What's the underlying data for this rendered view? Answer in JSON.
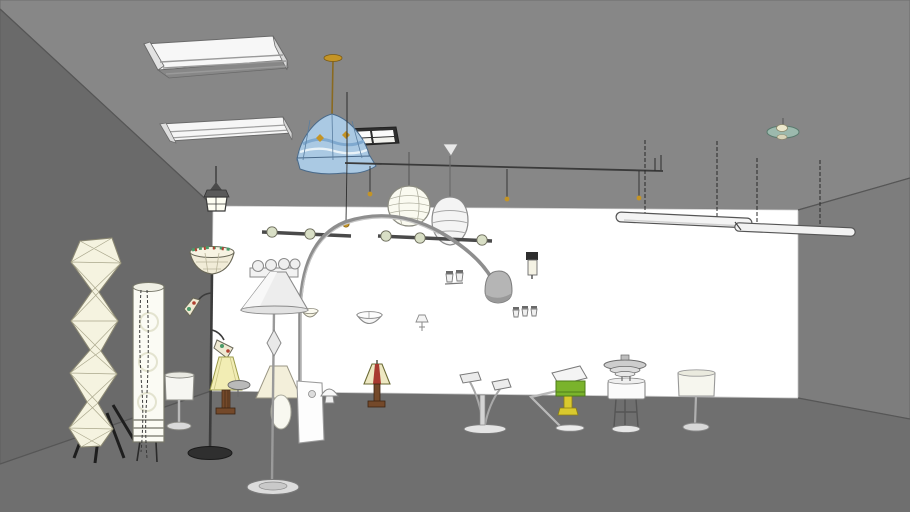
{
  "viewport": {
    "type": "3d-model-viewport",
    "description": "Showroom scene of lamp and light-fixture 3D models"
  },
  "colors": {
    "ceiling": "#878787",
    "wall_left": "#6a6a6a",
    "wall_right": "#7d7d7d",
    "wall_back": "#ffffff",
    "floor": "#6f6f6f",
    "fixture_white": "#f4f4f4",
    "paper_cream": "#f5f3e0",
    "shade_blue": "#aac9e3",
    "shade_blue_band": "#7fa9cf",
    "gold": "#c49425",
    "green_lamp": "#7ab32c",
    "yellow_metal": "#d9c92e",
    "wood_brown": "#74492a",
    "stripe_red": "#a83a30",
    "saucer_teal": "#9cb9ad",
    "metal_gray": "#9a9a9a",
    "metal_dark": "#3f3f3f",
    "dome_gray": "#b5b5b5",
    "mission_shade": "#eee8c2",
    "yellow_shade": "#f2edb4",
    "base_black": "#2f2f2f"
  },
  "scene": {
    "room_surfaces": [
      "ceiling",
      "left-wall",
      "back-wall",
      "right-wall",
      "floor"
    ],
    "ceiling_fixtures": [
      {
        "name": "fluorescent-troffer-1"
      },
      {
        "name": "fluorescent-strip-2"
      },
      {
        "name": "grid-panel-light"
      },
      {
        "name": "tiffany-blue-pendant"
      },
      {
        "name": "lantern-pendant"
      },
      {
        "name": "paper-sphere-pendant"
      },
      {
        "name": "cable-rail-system"
      },
      {
        "name": "ovoid-pendant"
      },
      {
        "name": "suspended-tube-light-1"
      },
      {
        "name": "suspended-tube-light-2"
      },
      {
        "name": "saucer-pendant"
      }
    ],
    "wall_fixtures": [
      {
        "name": "track-bar-left"
      },
      {
        "name": "track-bar-right"
      },
      {
        "name": "vanity-bulb-bar"
      },
      {
        "name": "half-bowl-sconce-small"
      },
      {
        "name": "half-bowl-sconce"
      },
      {
        "name": "torch-sconce"
      },
      {
        "name": "double-cup-sconce"
      },
      {
        "name": "box-sconce"
      },
      {
        "name": "triple-cup-sconce"
      }
    ],
    "floor_lamps": [
      {
        "name": "noguchi-paper-lamp"
      },
      {
        "name": "cylinder-paper-lamp"
      },
      {
        "name": "tiffany-torchiere"
      },
      {
        "name": "cone-shade-floor-lamp"
      },
      {
        "name": "arc-floor-lamp"
      },
      {
        "name": "pedestal-lamp"
      }
    ],
    "table_lamps": [
      {
        "name": "small-drum-table-lamp"
      },
      {
        "name": "yellow-shade-table-lamp"
      },
      {
        "name": "saucer-accent-lamp"
      },
      {
        "name": "mission-table-lamp"
      },
      {
        "name": "mushroom-mini-lamp"
      },
      {
        "name": "white-display-panel"
      },
      {
        "name": "twin-head-desk-lamp"
      },
      {
        "name": "green-task-lamp"
      },
      {
        "name": "ph-layered-lamp"
      },
      {
        "name": "drum-shade-table-lamp"
      }
    ]
  }
}
